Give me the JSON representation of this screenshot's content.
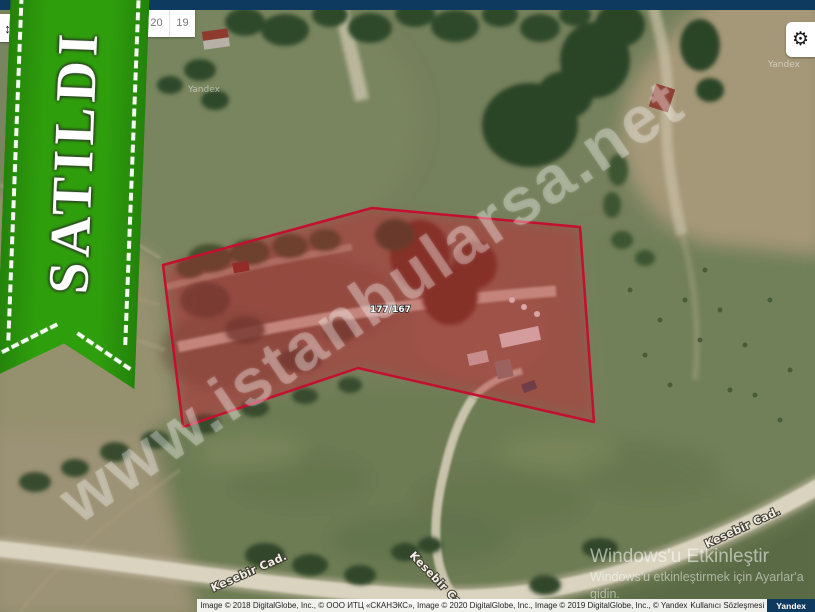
{
  "colors": {
    "ribbon-green": "#2f9e0c",
    "ribbon-green-dark": "#23830a",
    "parcel-stroke": "#c40f30",
    "parcel-fill": "rgba(193,28,48,0.32)",
    "top-bar-navy": "#0f3a5f",
    "yandex-badge-navy": "#0f3a5f"
  },
  "ribbon": {
    "label": "SATILDI"
  },
  "controls": {
    "pan_button_icon": "↕",
    "gear_button_icon": "⚙",
    "zoom_levels": [
      "20",
      "19"
    ]
  },
  "map": {
    "parcel_number": "177/167",
    "road_label": "Kesebir Cad.",
    "provider_watermark": "Yandex"
  },
  "watermark": {
    "site": "www.istanbularsa.net"
  },
  "windows_activation": {
    "title": "Windows'u Etkinleştir",
    "subtitle": "Windows'u etkinleştirmek için Ayarlar'a gidin."
  },
  "attribution": {
    "credits": "Image © 2018 DigitalGlobe, Inc., © ООО ИТЦ «СКАНЭКС», Image © 2020 DigitalGlobe, Inc., Image © 2019 DigitalGlobe, Inc., © Yandex",
    "terms_link": "Kullanıcı Sözleşmesi",
    "provider_logo": "Yandex"
  }
}
